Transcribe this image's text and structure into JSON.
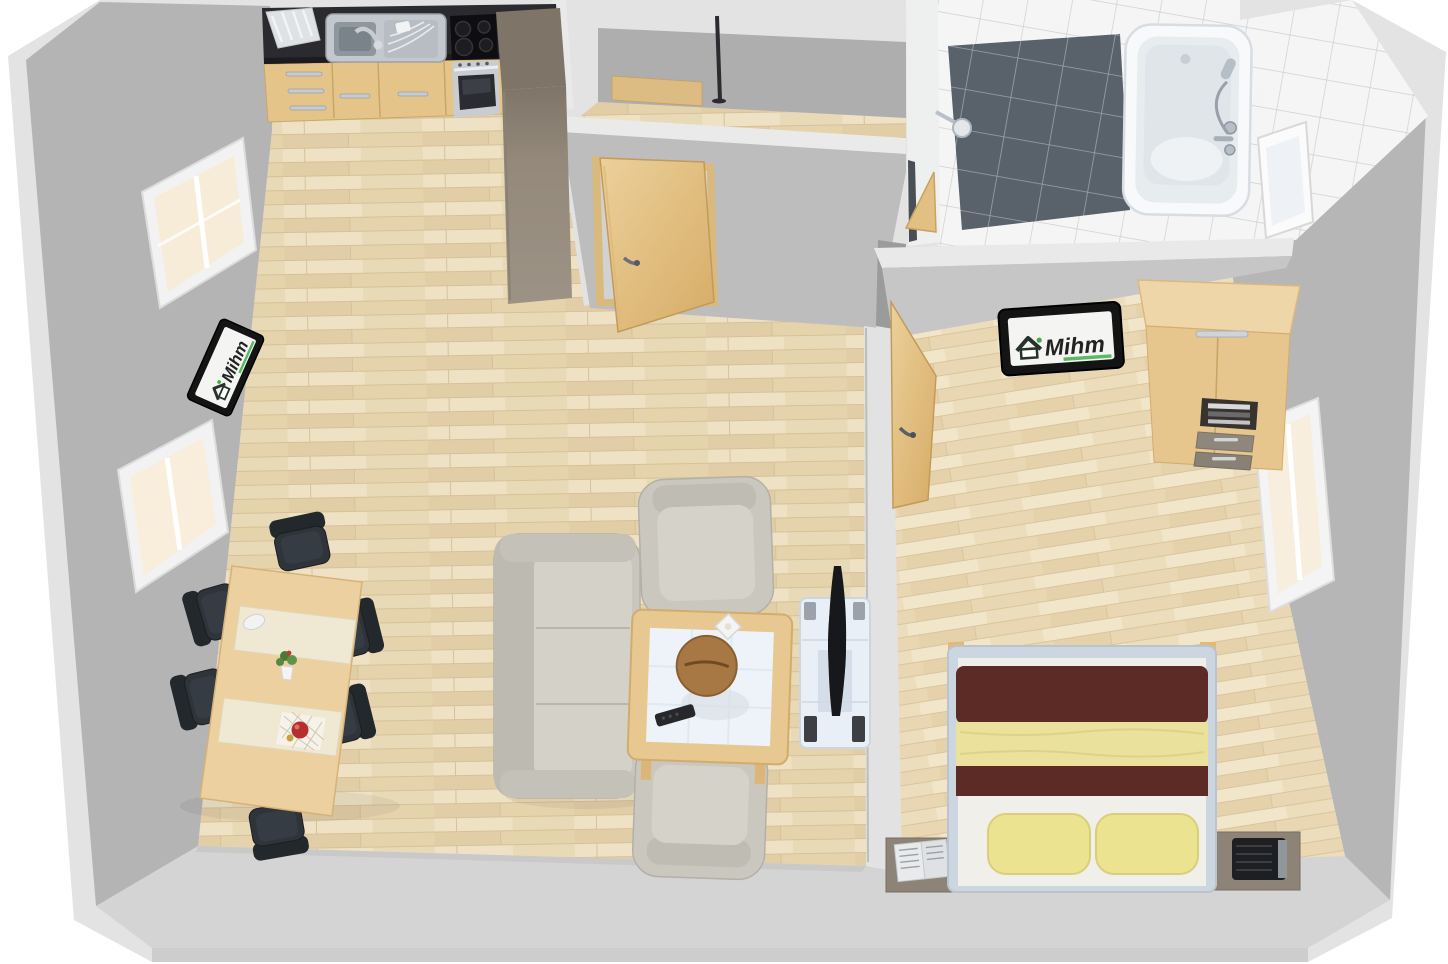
{
  "branding": {
    "logo_text": "Mihm"
  },
  "scene": {
    "type": "3d-floor-plan-render",
    "view": "top-down-perspective",
    "rooms": [
      {
        "name": "living-room-with-open-kitchen",
        "floor": "light wood laminate",
        "items": [
          "kitchen counter with sink",
          "dish rack",
          "ceramic cooktop",
          "oven",
          "tall cabinet",
          "dining table",
          "6 black chairs",
          "2 table runners",
          "flower vase",
          "fruit decoration",
          "sofa",
          "2 armchairs",
          "coffee table with wooden bowl",
          "remote control",
          "TV on glass stand",
          "wall TV with Mihm logo",
          "2 windows",
          "open door"
        ]
      },
      {
        "name": "hallway",
        "items": [
          "sideboard",
          "coat stand",
          "open door to living room"
        ]
      },
      {
        "name": "bathroom",
        "floor": "white and anthracite tiles",
        "items": [
          "bathtub with hand shower and faucet",
          "dark tiled shower area",
          "shower head",
          "open door",
          "window"
        ]
      },
      {
        "name": "bedroom",
        "floor": "light wood laminate",
        "items": [
          "double bed with dark red and yellow bedding",
          "2 yellow pillows",
          "2 nightstands",
          "open book",
          "radio alarm",
          "wardrobe with open shelf and drawers",
          "wall TV with Mihm logo",
          "open door",
          "window"
        ]
      }
    ],
    "colors": {
      "outer_wall_top": "#e3e3e3",
      "inner_wall_gray": "#b4b4b4",
      "floor_wood": "#ebdcbc",
      "countertop_black": "#2b2b2f",
      "cabinet_wood": "#e4c488",
      "chair_black": "#2e343a",
      "sofa_beige_gray": "#c9c6be",
      "bed_blanket_dark_red": "#5d2b26",
      "bed_blanket_yellow": "#e9e19c",
      "shower_tile_dark": "#59616a",
      "logo_green": "#3fae49",
      "tv_black": "#17181b"
    }
  }
}
